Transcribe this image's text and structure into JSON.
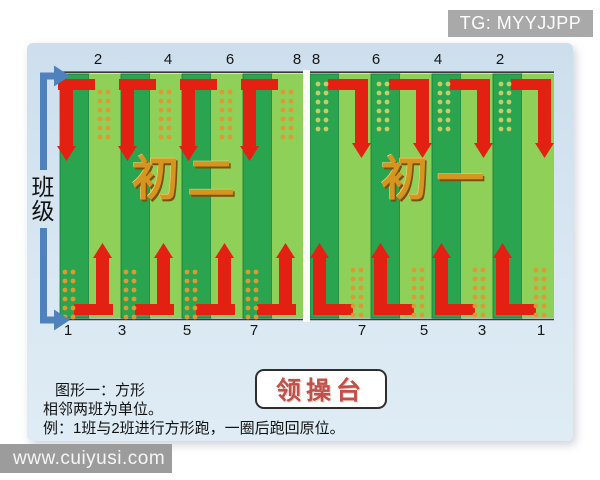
{
  "header": {
    "tg_label": "TG: MYYJJPP"
  },
  "watermark": {
    "url_label": "www.cuiyusi.com"
  },
  "axis": {
    "label": "班级"
  },
  "field": {
    "grade_left": "初二",
    "grade_right": "初一",
    "numbers": {
      "top_left": [
        "2",
        "4",
        "6",
        "8"
      ],
      "top_right": [
        "8",
        "6",
        "4",
        "2"
      ],
      "bottom_left": [
        "1",
        "3",
        "5",
        "7"
      ],
      "bottom_right": [
        "7",
        "5",
        "3",
        "1"
      ]
    },
    "colors": {
      "dark_stripe": "#2aa44e",
      "dark_stripe_edge": "#14793a",
      "light_stripe": "#8fd058",
      "arrow_red": "#e32112",
      "axis_blue": "#4f81bd",
      "dots_orange": "#dd9a33",
      "dots_pale": "#c6cc66",
      "border_line": "#3a3a3a",
      "divider": "#fbfdf4"
    }
  },
  "platform": {
    "label": "领操台"
  },
  "caption": {
    "line1": "图形一：方形",
    "line2": "相邻两班为单位。",
    "line3": "例：1班与2班进行方形跑，一圈后跑回原位。"
  }
}
